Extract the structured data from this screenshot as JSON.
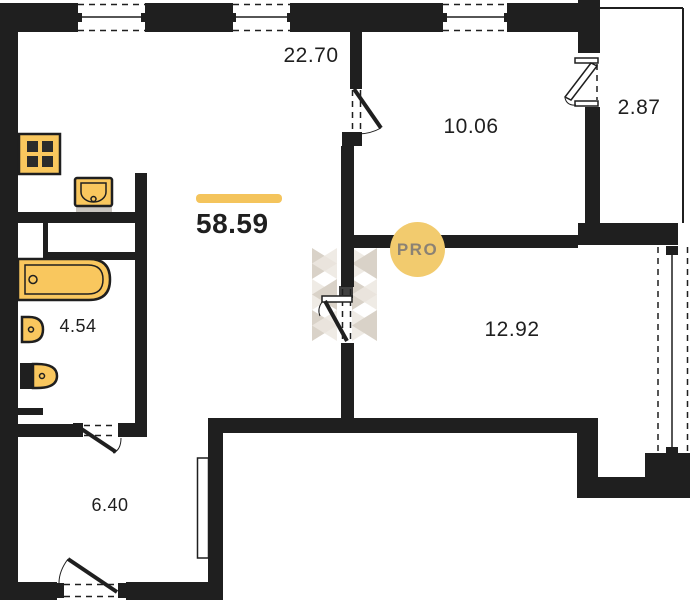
{
  "title": "apartment-floor-plan",
  "total": {
    "area": "58.59"
  },
  "badge": {
    "label": "PRO"
  },
  "rooms": {
    "living_kitchen": {
      "area": "22.70"
    },
    "bedroom": {
      "area": "10.06"
    },
    "balcony": {
      "area": "2.87"
    },
    "room2": {
      "area": "12.92"
    },
    "bathroom": {
      "area": "4.54"
    },
    "hallway": {
      "area": "6.40"
    }
  },
  "icons": [
    "stove-icon",
    "kitchen-sink-icon",
    "bathtub-icon",
    "washbasin-icon",
    "toilet-icon",
    "window-icon",
    "door-icon",
    "wardrobe-icon",
    "watermark-logo"
  ],
  "colors": {
    "wall": "#1f1f1f",
    "text": "#1f1f1f",
    "fixture": "#f9c75e",
    "fixture_dark": "#2b2b2b",
    "accent": "#f4c45c",
    "badge_bg": "#f2cb6e",
    "badge_text": "#8b8274",
    "counter_shadow": "#c9c5c0",
    "watermark_a": "#d9d2c8",
    "watermark_b": "#ece7e0"
  }
}
